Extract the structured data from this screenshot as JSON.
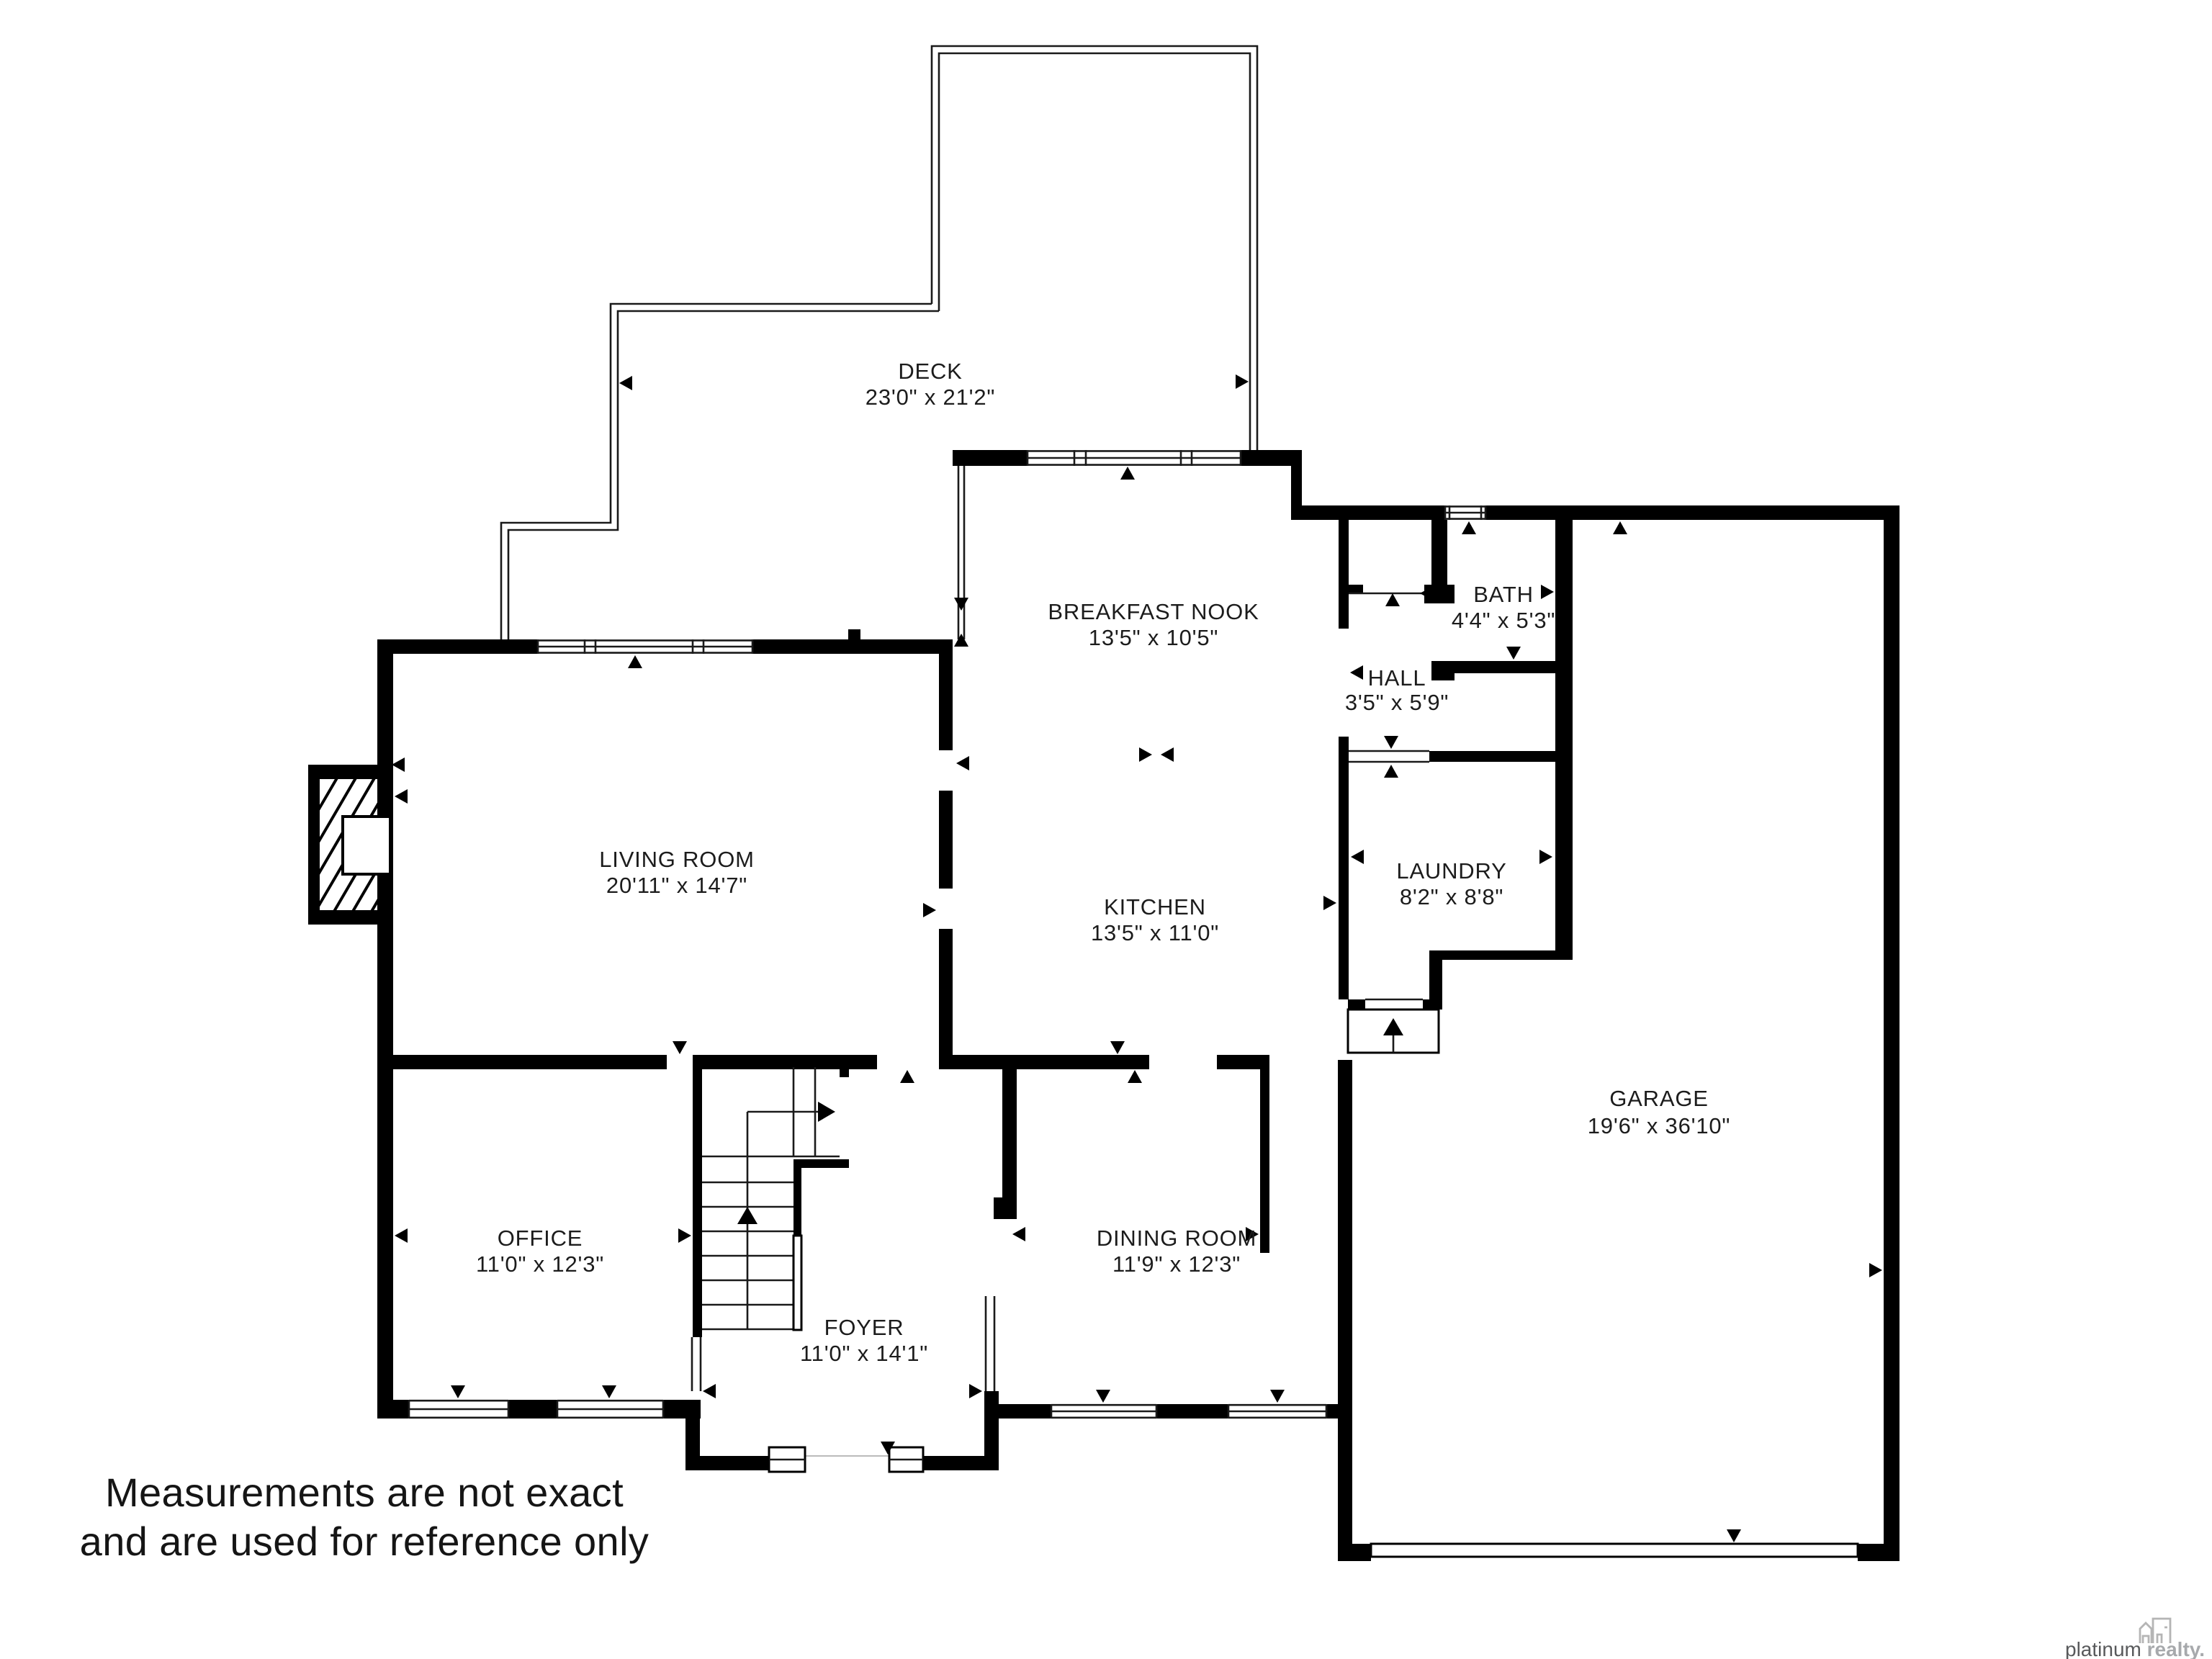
{
  "rooms": {
    "deck": {
      "name": "DECK",
      "dims": "23'0\" x 21'2\""
    },
    "breakfast": {
      "name": "BREAKFAST NOOK",
      "dims": "13'5\" x 10'5\""
    },
    "bath": {
      "name": "BATH",
      "dims": "4'4\" x 5'3\""
    },
    "hall": {
      "name": "HALL",
      "dims": "3'5\" x 5'9\""
    },
    "living": {
      "name": "LIVING ROOM",
      "dims": "20'11\" x 14'7\""
    },
    "kitchen": {
      "name": "KITCHEN",
      "dims": "13'5\" x 11'0\""
    },
    "laundry": {
      "name": "LAUNDRY",
      "dims": "8'2\" x 8'8\""
    },
    "garage": {
      "name": "GARAGE",
      "dims": "19'6\" x 36'10\""
    },
    "office": {
      "name": "OFFICE",
      "dims": "11'0\" x 12'3\""
    },
    "foyer": {
      "name": "FOYER",
      "dims": "11'0\" x 14'1\""
    },
    "dining": {
      "name": "DINING ROOM",
      "dims": "11'9\" x 12'3\""
    }
  },
  "disclaimer": {
    "line1": "Measurements are not exact",
    "line2": "and are used for reference only"
  },
  "logo": {
    "brand": "platinum ",
    "brand2": "realty."
  },
  "colors": {
    "wall": "#000000",
    "text": "#1c1c1c",
    "logo_gray": "#a7a9ac"
  }
}
